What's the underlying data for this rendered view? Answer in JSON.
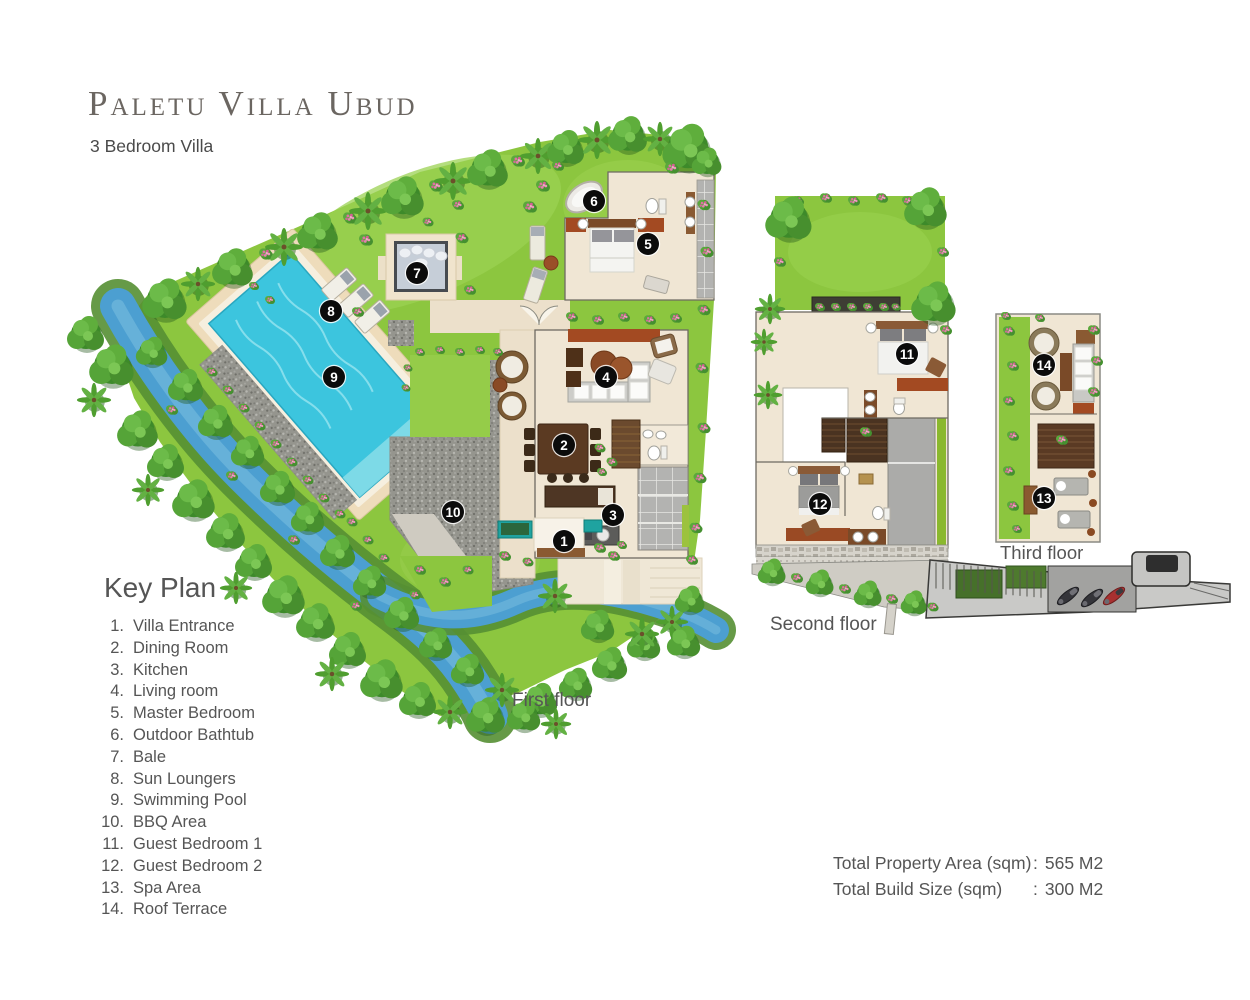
{
  "header": {
    "title": "Paletu Villa Ubud",
    "subtitle": "3 Bedroom Villa"
  },
  "key_plan": {
    "heading": "Key Plan",
    "items": [
      {
        "num": "1.",
        "label": "Villa Entrance"
      },
      {
        "num": "2.",
        "label": "Dining Room"
      },
      {
        "num": "3.",
        "label": "Kitchen"
      },
      {
        "num": "4.",
        "label": "Living room"
      },
      {
        "num": "5.",
        "label": "Master Bedroom"
      },
      {
        "num": "6.",
        "label": "Outdoor Bathtub"
      },
      {
        "num": "7.",
        "label": "Bale"
      },
      {
        "num": "8.",
        "label": "Sun Loungers"
      },
      {
        "num": "9.",
        "label": "Swimming Pool"
      },
      {
        "num": "10.",
        "label": "BBQ Area"
      },
      {
        "num": "11.",
        "label": "Guest Bedroom 1"
      },
      {
        "num": "12.",
        "label": "Guest Bedroom 2"
      },
      {
        "num": "13.",
        "label": "Spa Area"
      },
      {
        "num": "14.",
        "label": "Roof Terrace"
      }
    ]
  },
  "floor_labels": {
    "first": "First floor",
    "second": "Second floor",
    "third": "Third floor"
  },
  "totals": [
    {
      "label": "Total Property Area (sqm)",
      "sep": ":",
      "value": "565 M2"
    },
    {
      "label": "Total Build Size (sqm)",
      "sep": ":",
      "value": "300 M2"
    }
  ],
  "markers": {
    "first": [
      {
        "n": "1",
        "x": 564,
        "y": 541
      },
      {
        "n": "2",
        "x": 564,
        "y": 445
      },
      {
        "n": "3",
        "x": 613,
        "y": 515
      },
      {
        "n": "4",
        "x": 606,
        "y": 377
      },
      {
        "n": "5",
        "x": 648,
        "y": 244
      },
      {
        "n": "6",
        "x": 594,
        "y": 201
      },
      {
        "n": "7",
        "x": 417,
        "y": 273
      },
      {
        "n": "8",
        "x": 331,
        "y": 311
      },
      {
        "n": "9",
        "x": 334,
        "y": 377
      },
      {
        "n": "10",
        "x": 453,
        "y": 512
      }
    ],
    "second": [
      {
        "n": "11",
        "x": 907,
        "y": 354
      },
      {
        "n": "12",
        "x": 820,
        "y": 504
      }
    ],
    "third": [
      {
        "n": "13",
        "x": 1044,
        "y": 498
      },
      {
        "n": "14",
        "x": 1044,
        "y": 365
      }
    ]
  },
  "colors": {
    "lawn": "#8cc63f",
    "river": "#4c9fd1",
    "pool": "#3cc5de",
    "floor": "#f0e6d4",
    "terracotta": "#a34a22",
    "gravel": "#95958e",
    "text": "#555555"
  }
}
